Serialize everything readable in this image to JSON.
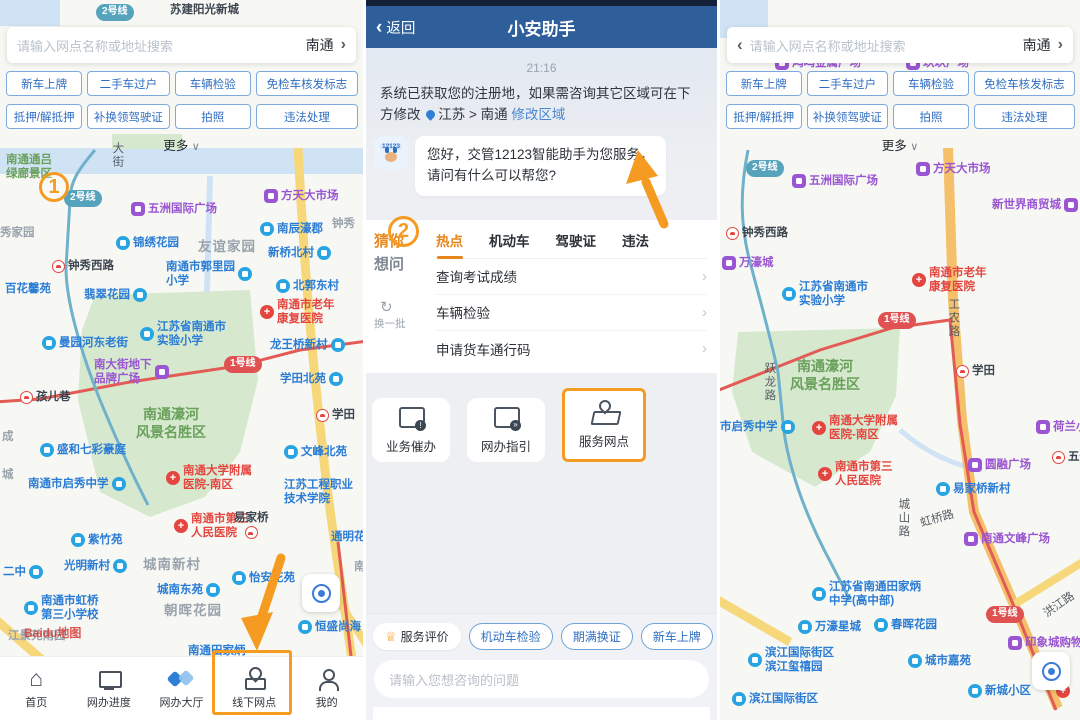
{
  "app": {
    "accent_orange": "#F59B22",
    "header_blue": "#2E5F9B",
    "poi_blue": "#29A4E2",
    "poi_purple": "#9A55D2",
    "poi_red": "#E4453F",
    "metro_red_badge": "#E05252",
    "metro_teal_badge": "#56A3BD"
  },
  "icons": {
    "back_chevron": "‹",
    "chevron_right": "›",
    "caret_down": "∨",
    "refresh": "↻",
    "medal": "♕"
  },
  "left_panel": {
    "search": {
      "placeholder": "请输入网点名称或地址搜索",
      "city": "南通"
    },
    "service_buttons": [
      "新车上牌",
      "二手车过户",
      "车辆检验",
      "免检车核发标志",
      "抵押/解抵押",
      "补换领驾驶证",
      "拍照",
      "违法处理"
    ],
    "more_label": "更多",
    "step_badge": "1",
    "map_labels": [
      {
        "t": "苏建阳光新城",
        "x": 170,
        "y": 3,
        "c": "dark"
      },
      {
        "t": "2号线",
        "x": 96,
        "y": 4,
        "c": "mteal"
      },
      {
        "t": "南通通吕\n绿廊景区",
        "x": 6,
        "y": 153,
        "c": "green"
      },
      {
        "t": "1",
        "x": 39,
        "y": 172,
        "c": "step"
      },
      {
        "t": "2号线",
        "x": 64,
        "y": 190,
        "c": "mteal"
      },
      {
        "t": "大街",
        "x": 110,
        "y": 142,
        "c": "roadv"
      },
      {
        "t": "五洲国际广场",
        "x": 131,
        "y": 202,
        "c": "pp"
      },
      {
        "t": "方天大市场",
        "x": 264,
        "y": 189,
        "c": "pp"
      },
      {
        "t": "南辰濠郡",
        "x": 260,
        "y": 222,
        "c": "pb"
      },
      {
        "t": "钟秀",
        "x": 332,
        "y": 217,
        "c": "gray"
      },
      {
        "t": "秀家园",
        "x": 0,
        "y": 226,
        "c": "gray"
      },
      {
        "t": "锦绣花园",
        "x": 116,
        "y": 236,
        "c": "pb"
      },
      {
        "t": "友谊家园",
        "x": 198,
        "y": 239,
        "c": "graylg"
      },
      {
        "t": "新桥北村",
        "x": 268,
        "y": 246,
        "c": "pb",
        "side": "r"
      },
      {
        "t": "钟秀西路",
        "x": 52,
        "y": 259,
        "c": "st"
      },
      {
        "t": "南通市郭里园\n小学",
        "x": 166,
        "y": 260,
        "c": "pb",
        "side": "r"
      },
      {
        "t": "百花馨苑",
        "x": 5,
        "y": 282,
        "c": "blue"
      },
      {
        "t": "翡翠花园",
        "x": 84,
        "y": 288,
        "c": "pb",
        "side": "r"
      },
      {
        "t": "北郭东村",
        "x": 276,
        "y": 279,
        "c": "pb"
      },
      {
        "t": "南通市老年\n康复医院",
        "x": 260,
        "y": 298,
        "c": "pr"
      },
      {
        "t": "曼园河东老街",
        "x": 42,
        "y": 336,
        "c": "pb"
      },
      {
        "t": "江苏省南通市\n实验小学",
        "x": 140,
        "y": 320,
        "c": "pb"
      },
      {
        "t": "龙王桥新村",
        "x": 270,
        "y": 338,
        "c": "pb",
        "side": "r"
      },
      {
        "t": "南大街地下\n品牌广场",
        "x": 94,
        "y": 358,
        "c": "pp",
        "side": "r"
      },
      {
        "t": "1号线",
        "x": 224,
        "y": 356,
        "c": "mred"
      },
      {
        "t": "学田北苑",
        "x": 280,
        "y": 372,
        "c": "pb",
        "side": "r"
      },
      {
        "t": "孩儿巷",
        "x": 20,
        "y": 390,
        "c": "st"
      },
      {
        "t": "学田",
        "x": 316,
        "y": 408,
        "c": "st"
      },
      {
        "t": "南通濠河\n风景名胜区",
        "x": 136,
        "y": 406,
        "c": "green2"
      },
      {
        "t": "盛和七彩豪庭",
        "x": 40,
        "y": 443,
        "c": "pb"
      },
      {
        "t": "文峰北苑",
        "x": 284,
        "y": 445,
        "c": "pb"
      },
      {
        "t": "成",
        "x": 2,
        "y": 430,
        "c": "gray"
      },
      {
        "t": "城",
        "x": 2,
        "y": 468,
        "c": "gray"
      },
      {
        "t": "南通市启秀中学",
        "x": 28,
        "y": 477,
        "c": "pb",
        "side": "r"
      },
      {
        "t": "南通大学附属\n医院-南区",
        "x": 166,
        "y": 464,
        "c": "pr"
      },
      {
        "t": "江苏工程职业\n技术学院",
        "x": 284,
        "y": 478,
        "c": "blue"
      },
      {
        "t": "南通市第三\n人民医院",
        "x": 174,
        "y": 512,
        "c": "pr"
      },
      {
        "t": "易家桥",
        "x": 234,
        "y": 511,
        "c": "st2"
      },
      {
        "t": "通明花苑",
        "x": 331,
        "y": 530,
        "c": "blue"
      },
      {
        "t": "紫竹苑",
        "x": 71,
        "y": 533,
        "c": "pb"
      },
      {
        "t": "二中",
        "x": 3,
        "y": 565,
        "c": "pb",
        "side": "r"
      },
      {
        "t": "光明新村",
        "x": 64,
        "y": 559,
        "c": "pb",
        "side": "r"
      },
      {
        "t": "城南新村",
        "x": 143,
        "y": 557,
        "c": "graylg"
      },
      {
        "t": "怡安花苑",
        "x": 232,
        "y": 571,
        "c": "pb"
      },
      {
        "t": "城南东苑",
        "x": 157,
        "y": 583,
        "c": "pb",
        "side": "r"
      },
      {
        "t": "朝晖花园",
        "x": 164,
        "y": 603,
        "c": "graylg"
      },
      {
        "t": "南通市虹桥\n第三小学校",
        "x": 24,
        "y": 594,
        "c": "pb"
      },
      {
        "t": "江景苑南园",
        "x": 8,
        "y": 629,
        "c": "gray"
      },
      {
        "t": "Baidu地图",
        "x": 24,
        "y": 626,
        "c": "wm"
      },
      {
        "t": "恒盛尚海",
        "x": 298,
        "y": 620,
        "c": "pb"
      },
      {
        "t": "南",
        "x": 354,
        "y": 560,
        "c": "gray"
      },
      {
        "t": "南通田家炳",
        "x": 188,
        "y": 644,
        "c": "blue"
      }
    ],
    "tabbar": [
      {
        "label": "首页",
        "icon": "home"
      },
      {
        "label": "网办进度",
        "icon": "monitor"
      },
      {
        "label": "网办大厅",
        "icon": "hall"
      },
      {
        "label": "线下网点",
        "icon": "pin",
        "highlighted": true
      },
      {
        "label": "我的",
        "icon": "user"
      }
    ]
  },
  "chat_panel": {
    "header": {
      "back_label": "返回",
      "title": "小安助手"
    },
    "timestamp": "21:16",
    "system_message": "系统已获取您的注册地，如果需咨询其它区域可在下方修改",
    "region_path": "江苏 > 南通",
    "region_edit_label": "修改区域",
    "avatar_label": "12123",
    "bot_message": "您好，交管12123智能助手为您服务，\n请问有什么可以帮您?",
    "step_badge": "2",
    "guess_panel": {
      "title_top": "猜你",
      "title_bottom": "想问",
      "refresh_label": "换一批",
      "tabs": [
        "热点",
        "机动车",
        "驾驶证",
        "违法"
      ],
      "active_tab": "热点",
      "questions": [
        "查询考试成绩",
        "车辆检验",
        "申请货车通行码"
      ]
    },
    "action_cards": [
      {
        "label": "业务催办",
        "icon": "doc"
      },
      {
        "label": "网办指引",
        "icon": "guide"
      },
      {
        "label": "服务网点",
        "icon": "mappin",
        "highlighted": true
      }
    ],
    "footer": {
      "rating_label": "服务评价",
      "quick_chips": [
        "机动车检验",
        "期满换证",
        "新车上牌"
      ],
      "input_placeholder": "请输入您想咨询的问题"
    }
  },
  "right_panel": {
    "search": {
      "placeholder": "请输入网点名称或地址搜索",
      "city": "南通"
    },
    "service_buttons": [
      "新车上牌",
      "二手车过户",
      "车辆检验",
      "免检车核发标志",
      "抵押/解抵押",
      "补换领驾驶证",
      "拍照",
      "违法处理"
    ],
    "more_label": "更多",
    "map_labels": [
      {
        "t": "鸿鸣金属广场",
        "x": 55,
        "y": 56,
        "c": "pp"
      },
      {
        "t": "玖玖广场",
        "x": 186,
        "y": 56,
        "c": "pp"
      },
      {
        "t": "2号线",
        "x": 26,
        "y": 160,
        "c": "mteal"
      },
      {
        "t": "五洲国际广场",
        "x": 72,
        "y": 174,
        "c": "pp"
      },
      {
        "t": "方天大市场",
        "x": 196,
        "y": 162,
        "c": "pp"
      },
      {
        "t": "新世界商贸城",
        "x": 272,
        "y": 198,
        "c": "pp",
        "side": "r"
      },
      {
        "t": "钟秀西路",
        "x": 6,
        "y": 226,
        "c": "st"
      },
      {
        "t": "万濠城",
        "x": 2,
        "y": 256,
        "c": "pp"
      },
      {
        "t": "江苏省南通市\n实验小学",
        "x": 62,
        "y": 280,
        "c": "pb"
      },
      {
        "t": "南通市老年\n康复医院",
        "x": 192,
        "y": 266,
        "c": "pr"
      },
      {
        "t": "1号线",
        "x": 158,
        "y": 312,
        "c": "mred"
      },
      {
        "t": "工农路",
        "x": 226,
        "y": 298,
        "c": "roadv"
      },
      {
        "t": "南通濠河\n风景名胜区",
        "x": 70,
        "y": 358,
        "c": "green2"
      },
      {
        "t": "跃龙路",
        "x": 42,
        "y": 362,
        "c": "roadv"
      },
      {
        "t": "学田",
        "x": 236,
        "y": 364,
        "c": "st"
      },
      {
        "t": "市启秀中学",
        "x": 0,
        "y": 420,
        "c": "pb",
        "side": "r"
      },
      {
        "t": "南通大学附属\n医院-南区",
        "x": 92,
        "y": 414,
        "c": "pr"
      },
      {
        "t": "荷兰小镇",
        "x": 316,
        "y": 420,
        "c": "pp"
      },
      {
        "t": "南通市第三\n人民医院",
        "x": 98,
        "y": 460,
        "c": "pr"
      },
      {
        "t": "圆融广场",
        "x": 248,
        "y": 458,
        "c": "pp"
      },
      {
        "t": "五一",
        "x": 332,
        "y": 450,
        "c": "st"
      },
      {
        "t": "易家桥新村",
        "x": 216,
        "y": 482,
        "c": "pb"
      },
      {
        "t": "城山路",
        "x": 176,
        "y": 498,
        "c": "roadv"
      },
      {
        "t": "虹桥路",
        "x": 200,
        "y": 512,
        "c": "road",
        "rot": -16
      },
      {
        "t": "南通文峰广场",
        "x": 244,
        "y": 532,
        "c": "pp"
      },
      {
        "t": "江苏省南通田家炳\n中学(高中部)",
        "x": 92,
        "y": 580,
        "c": "pb"
      },
      {
        "t": "万濠星城",
        "x": 78,
        "y": 620,
        "c": "pb"
      },
      {
        "t": "春晖花园",
        "x": 154,
        "y": 618,
        "c": "pb"
      },
      {
        "t": "1号线",
        "x": 266,
        "y": 606,
        "c": "mred"
      },
      {
        "t": "洪江路",
        "x": 322,
        "y": 598,
        "c": "road",
        "rot": -35
      },
      {
        "t": "印象城购物中心",
        "x": 288,
        "y": 636,
        "c": "pp"
      },
      {
        "t": "滨江国际街区\n滨江玺禧园",
        "x": 28,
        "y": 646,
        "c": "pb"
      },
      {
        "t": "城市嘉苑",
        "x": 188,
        "y": 654,
        "c": "pb"
      },
      {
        "t": "新城小区",
        "x": 248,
        "y": 684,
        "c": "pb"
      },
      {
        "t": "滨江国际街区",
        "x": 12,
        "y": 692,
        "c": "pb"
      },
      {
        "t": "",
        "x": 336,
        "y": 684,
        "c": "pr"
      }
    ]
  }
}
